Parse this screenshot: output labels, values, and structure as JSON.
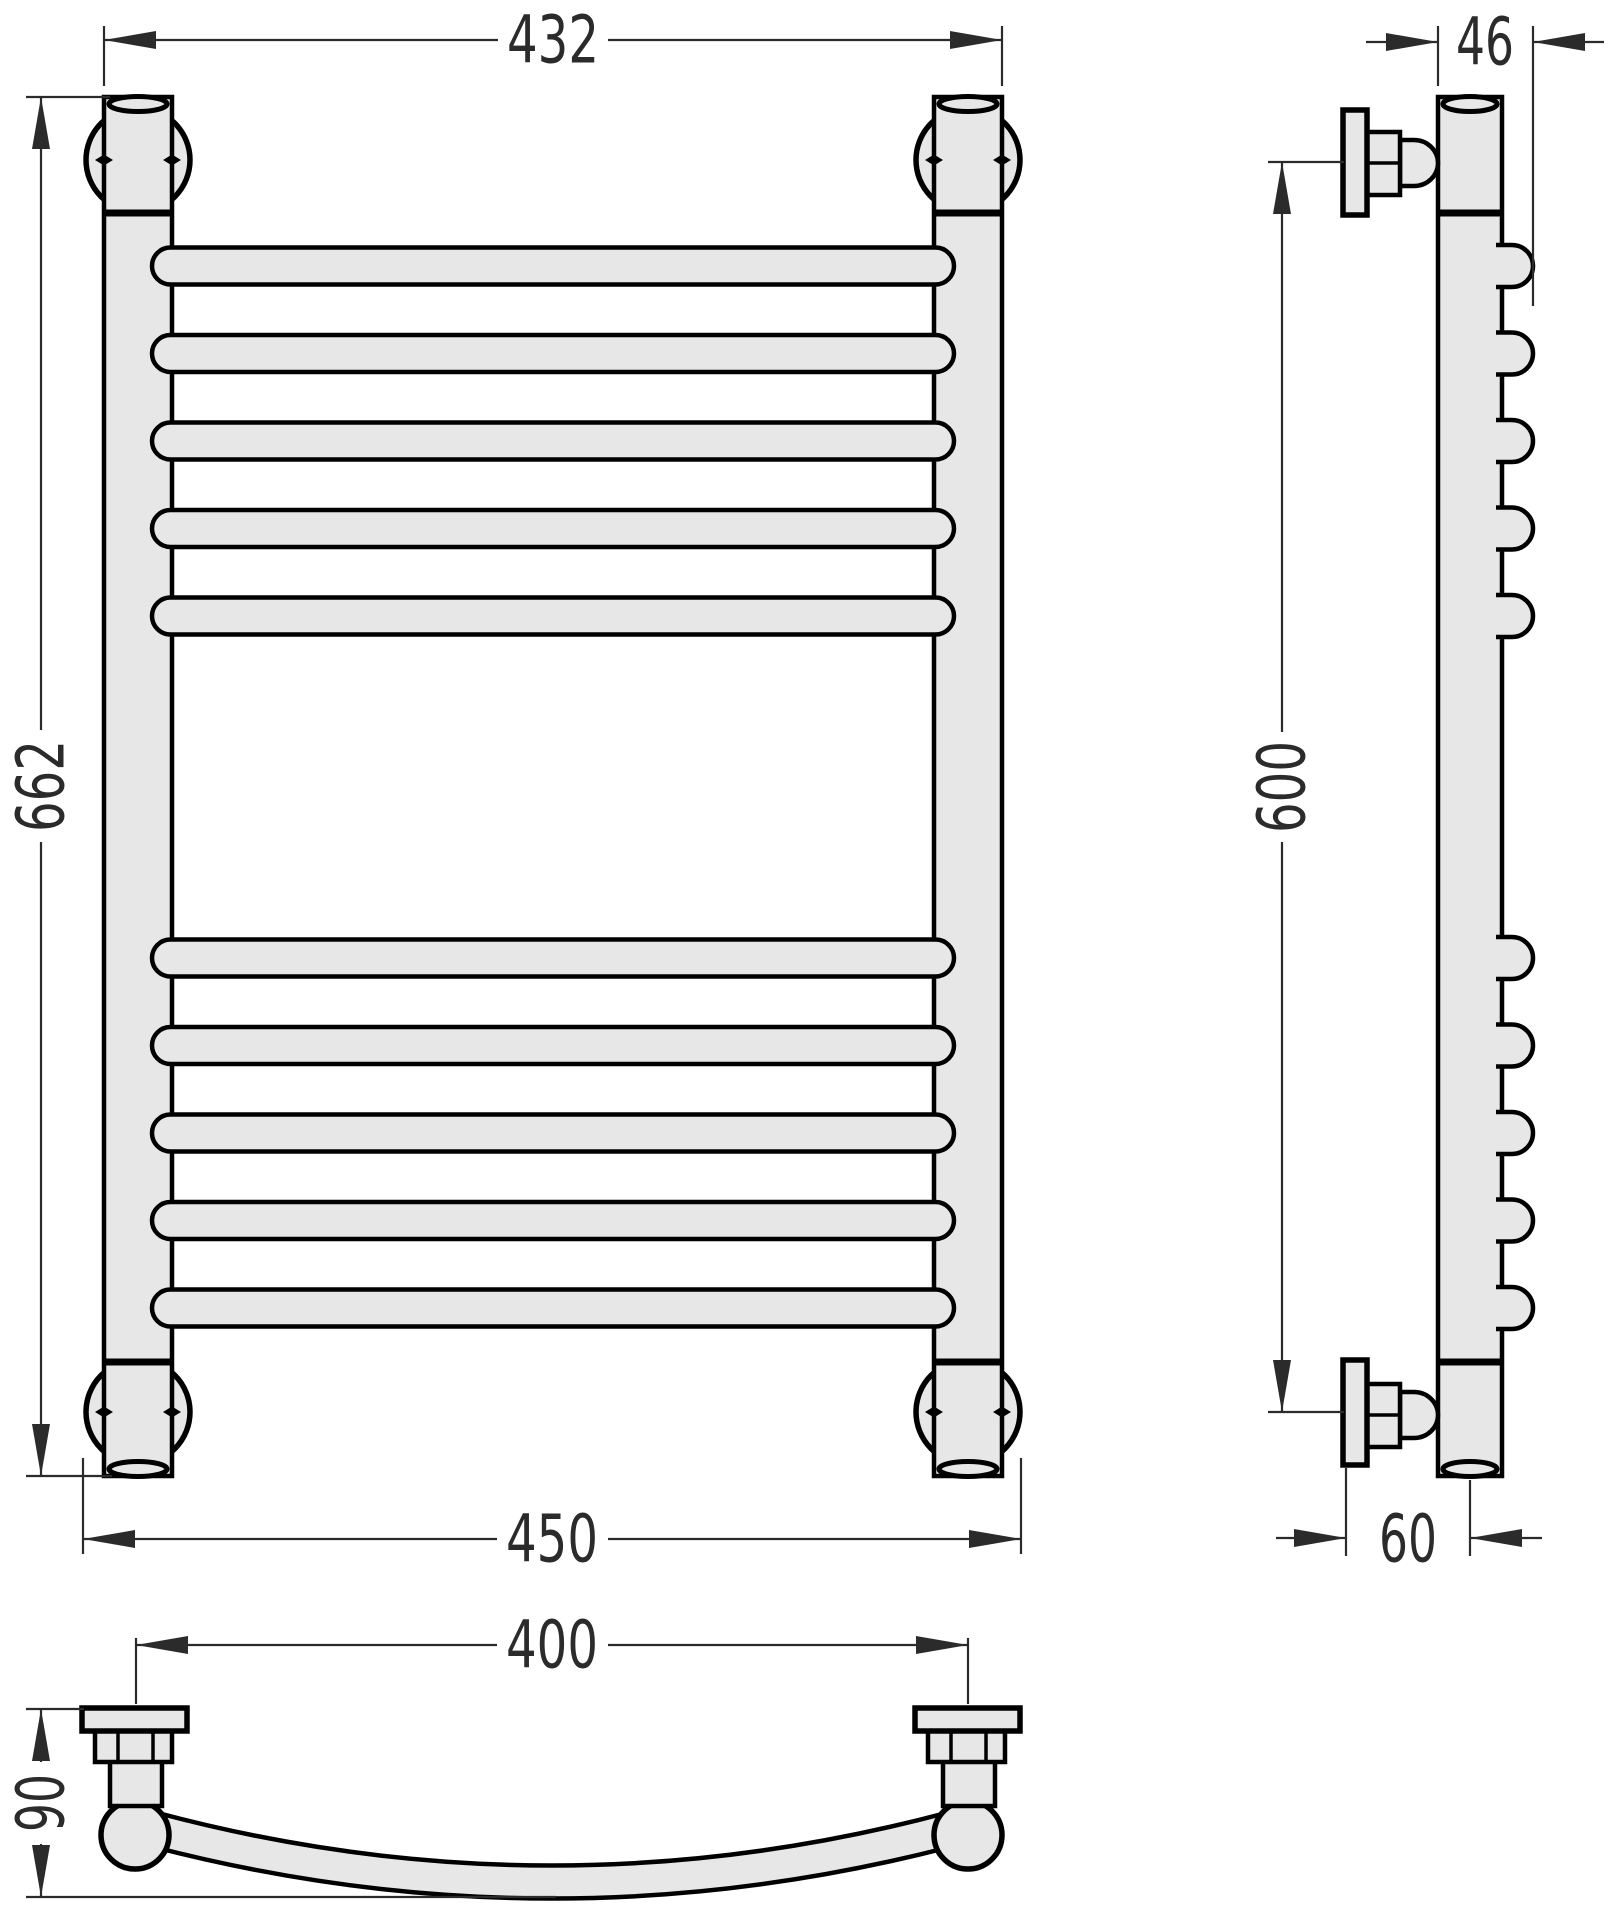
{
  "page": {
    "title": "Technical dimension drawing — wall-mounted towel rail, three views"
  },
  "drawing": {
    "background": "#ffffff",
    "part_fill": "#e7e7e7",
    "outline_color": "#000000",
    "dimension_color": "#2b2b2b",
    "views": {
      "front": {
        "name": "front view",
        "rung_count": 10,
        "rung_groups": [
          5,
          5
        ],
        "dimensions": {
          "outer_width_top": "432",
          "overall_height": "662",
          "outer_width_bottom": "450"
        }
      },
      "side": {
        "name": "side view",
        "bump_count": 10,
        "dimensions": {
          "depth": "46",
          "bracket_spacing": "600",
          "wall_to_axis": "60"
        }
      },
      "top": {
        "name": "top view",
        "dimensions": {
          "mount_spacing": "400",
          "wall_clearance": "90"
        }
      }
    }
  }
}
